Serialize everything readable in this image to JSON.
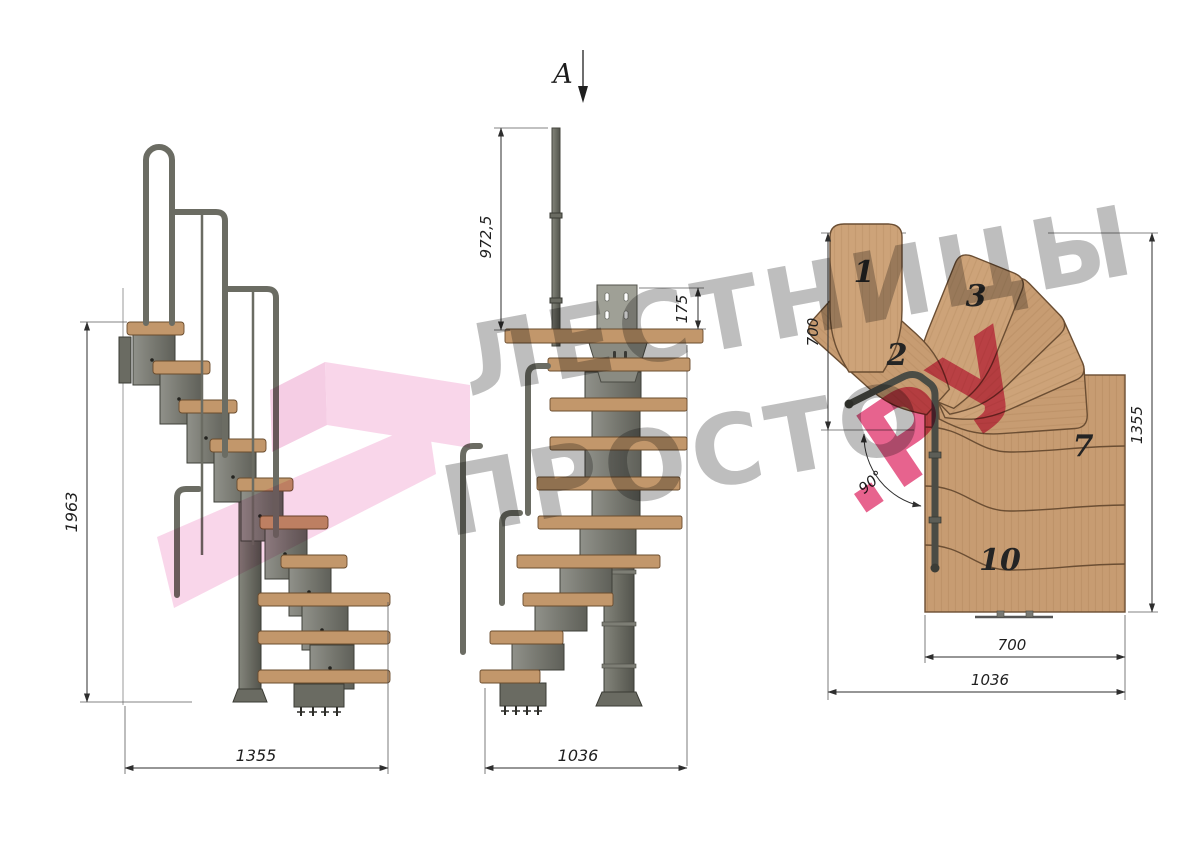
{
  "watermark": {
    "line1": "ЛЕСТНИЦЫ",
    "line2": "ПРОСТО",
    "suffix": ".РУ"
  },
  "section": {
    "label": "А"
  },
  "side_view": {
    "height_dim": "1963",
    "width_dim": "1355"
  },
  "front_view": {
    "post_dim": "972,5",
    "plate_dim": "175",
    "width_dim": "1036"
  },
  "plan_view": {
    "depth_dim": "700",
    "height_dim": "1355",
    "inner_width_dim": "700",
    "outer_width_dim": "1036",
    "angle_dim": "90°",
    "treads": {
      "t1": "1",
      "t2": "2",
      "t3": "3",
      "t7": "7",
      "t10": "10"
    }
  },
  "colors": {
    "wood": "#c2976b",
    "plan_wood": "#c79c72",
    "steel": "#7b7c73",
    "rail": "#6b6c63",
    "dim_line": "#2e2e2e",
    "watermark_gray": "#7d7d7d",
    "watermark_pink": "#e0376e",
    "ribbon_pink": "#f3aed6"
  }
}
